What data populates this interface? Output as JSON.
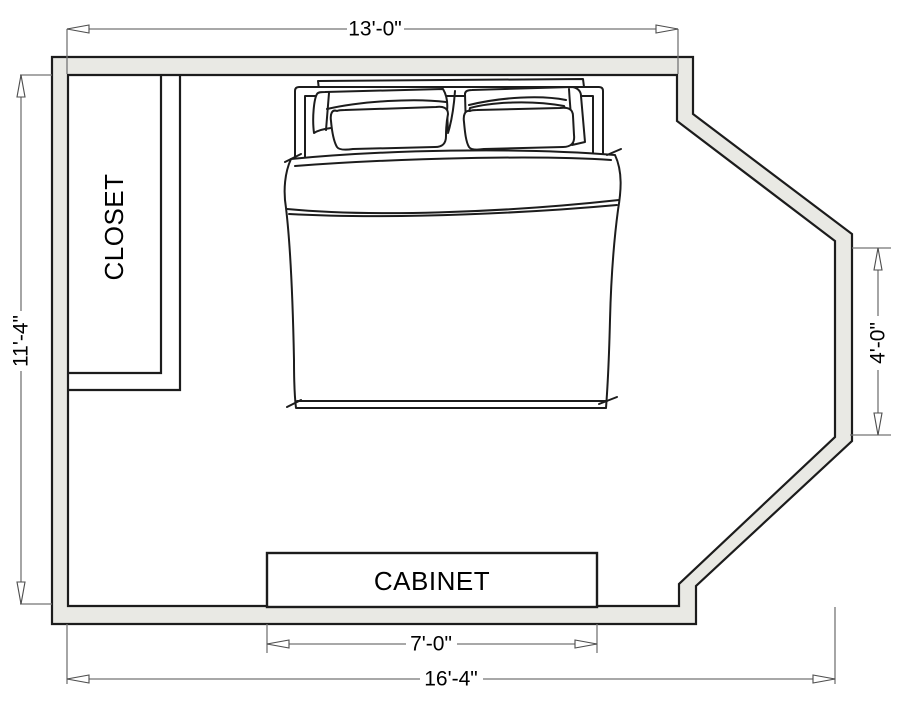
{
  "title": "Bedroom floor plan",
  "colors": {
    "wall_fill": "#e9e9e4",
    "outline": "#1c1c1c",
    "dimension": "#757575",
    "label_text": "#000000"
  },
  "labels": {
    "closet": "CLOSET",
    "cabinet": "CABINET"
  },
  "dimensions": {
    "top_width": "13'-0\"",
    "left_height": "11'-4\"",
    "right_bay": "4'-0\"",
    "cabinet_width": "7'-0\"",
    "bottom_width": "16'-4\""
  }
}
